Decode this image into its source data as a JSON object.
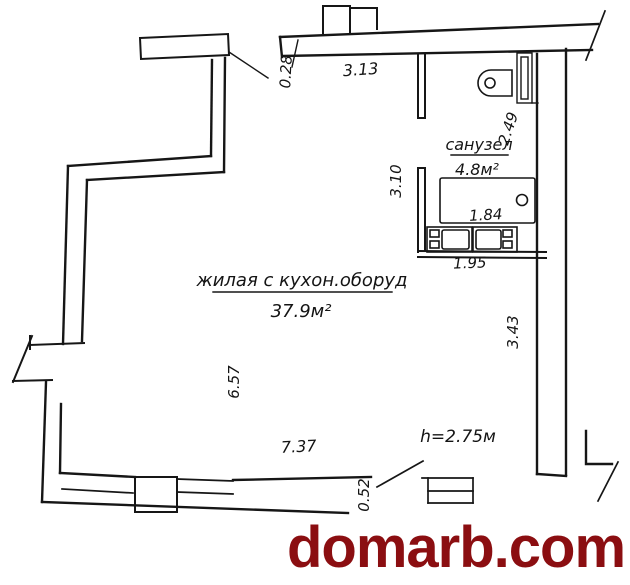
{
  "plan": {
    "living_room": {
      "name": "жилая с кухон.оборуд",
      "area": "37.9м²"
    },
    "bathroom": {
      "name": "санузел",
      "area": "4.8м²"
    },
    "ceiling_height": "h=2.75м",
    "dimensions": {
      "top_offset": "0.28",
      "top_wall": "3.13",
      "bathroom_right_wall": "2.49",
      "bathroom_left_wall": "3.10",
      "bathtub_width": "1.84",
      "kitchen_units_width": "1.95",
      "right_wall": "3.43",
      "left_wall": "6.57",
      "bottom_wall": "7.37",
      "bottom_offset": "0.52"
    },
    "colors": {
      "line": "#161616",
      "background": "#ffffff",
      "watermark_red": "#8b0e11"
    }
  },
  "watermark": {
    "text": "domarb.com"
  }
}
